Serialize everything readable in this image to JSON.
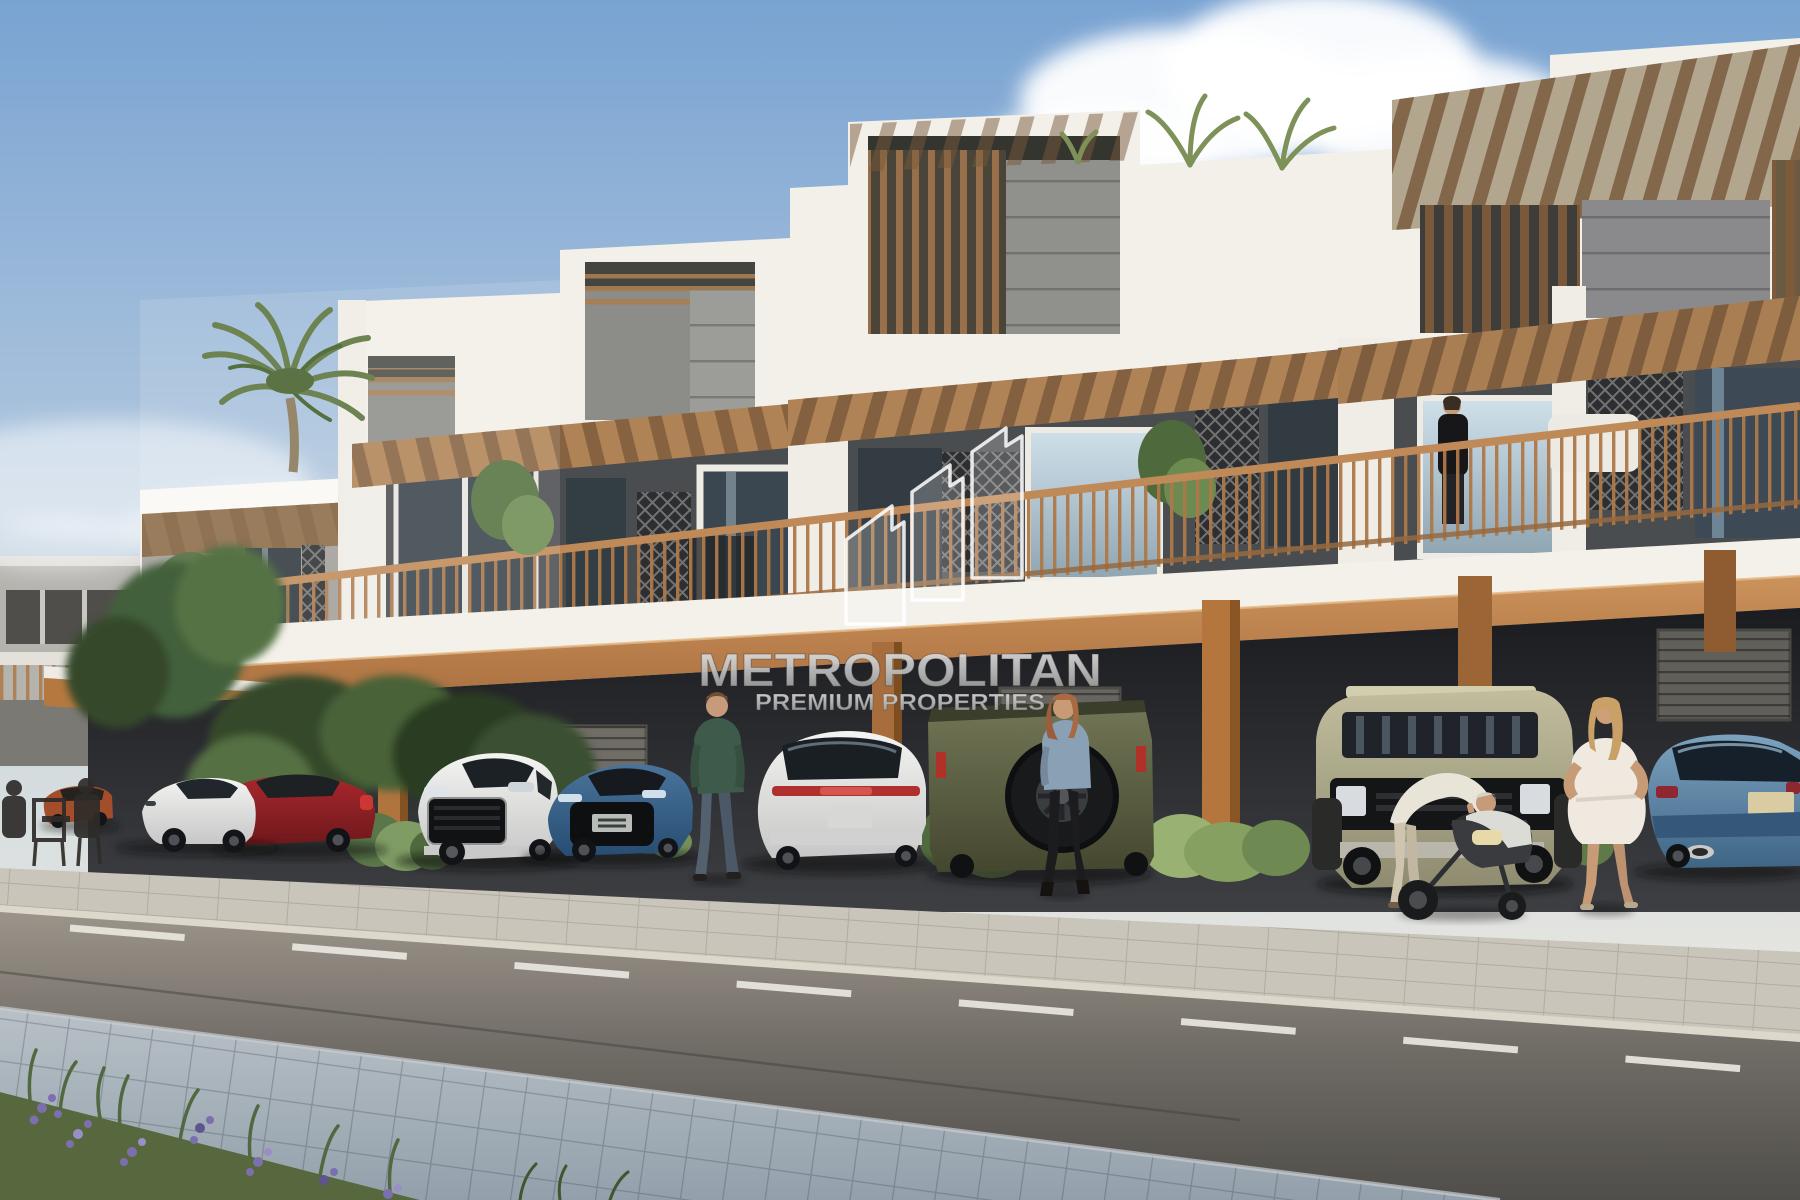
{
  "image": {
    "kind": "architectural-rendering",
    "subject": "Modern two-storey townhouse row with wooden pergolas, covered carport parking, people on a sidewalk and a street in the foreground under a daytime sky"
  },
  "watermark": {
    "title": "METROPOLITAN",
    "subtitle": "PREMIUM PROPERTIES",
    "logo": "ascending-buildings-logo",
    "text_color": "#c7c7c7",
    "logo_color": "rgba(255,255,255,0.8)"
  },
  "scene": {
    "sky": {
      "top": "#79a3d2",
      "horizon": "#efece6",
      "clouds": "white cumulus upper right, haze lower left"
    },
    "building": {
      "walls": "#f3f0e9",
      "stone": "#4a4d50",
      "pergola_wood": "#b98c5e",
      "railing_wood": "#b07848",
      "fascia_accent": "#b5793f"
    },
    "vehicles": [
      {
        "name": "orange-hatchback-distant",
        "color": "#a34e2b"
      },
      {
        "name": "white-electric-sedan",
        "color": "#e9e9e7"
      },
      {
        "name": "red-coupe",
        "color": "#8e2025"
      },
      {
        "name": "white-luxury-suv",
        "color": "#e2e3e2"
      },
      {
        "name": "blue-sports-sedan",
        "color": "#3a648e"
      },
      {
        "name": "white-suv-rear-view",
        "color": "#e6e6e4"
      },
      {
        "name": "olive-offroad-suv-with-spare-tire",
        "color": "#62664a"
      },
      {
        "name": "sage-offroad-suv-front-view",
        "color": "#b2ae8e"
      },
      {
        "name": "steel-blue-sedan-rear-view",
        "color": "#5d87aa"
      }
    ],
    "people": [
      {
        "name": "cafe-sitters-far-left"
      },
      {
        "name": "man-in-green-sweater-walking"
      },
      {
        "name": "woman-in-denim-jacket-walking"
      },
      {
        "name": "woman-in-black-on-balcony"
      },
      {
        "name": "parent-bending-over-stroller"
      },
      {
        "name": "woman-in-white-dress"
      }
    ],
    "ground": {
      "road": "#6b6862",
      "lane_marking": "#e9e7e0",
      "sidewalk": "#cac5ba",
      "paver_walkway": "#a4b0ba",
      "grass": "#5a6c42",
      "flowers": "#7c6fae"
    },
    "vegetation": [
      "palm-tree-left",
      "rooftop-palms",
      "balcony-plants",
      "hedges-between-cars"
    ]
  }
}
